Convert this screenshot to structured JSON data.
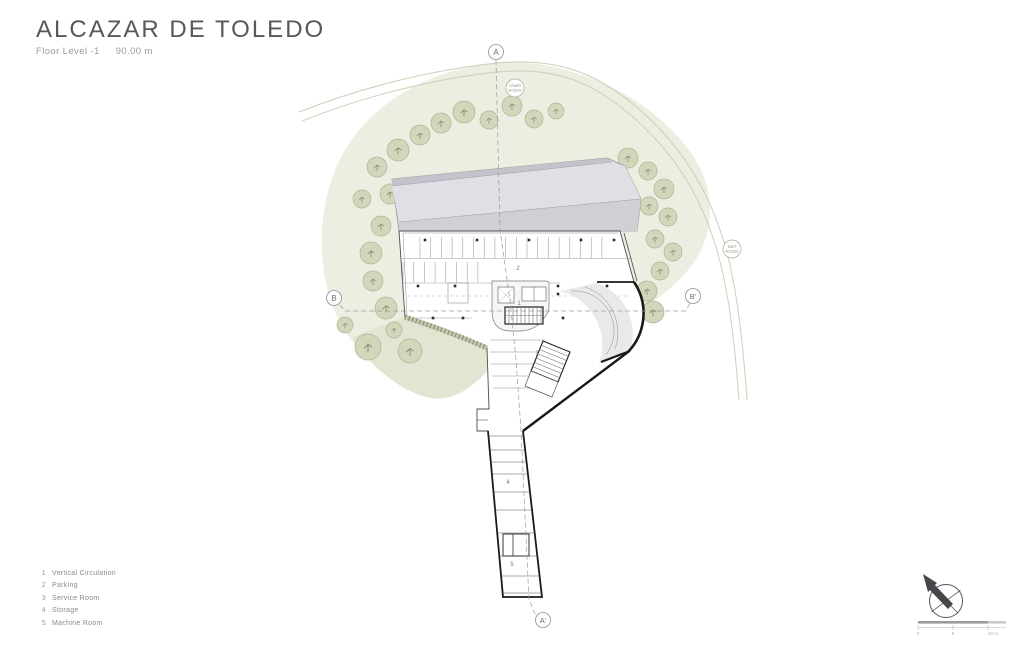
{
  "header": {
    "title": "ALCAZAR DE TOLEDO",
    "floor_label": "Floor Level -1",
    "elevation": "90.00 m"
  },
  "legend": {
    "items": [
      {
        "num": "1",
        "label": "Vertical Circulation"
      },
      {
        "num": "2",
        "label": "Parking"
      },
      {
        "num": "3",
        "label": "Service Room"
      },
      {
        "num": "4",
        "label": "Storage"
      },
      {
        "num": "5",
        "label": "Machine Room"
      }
    ]
  },
  "section_markers": {
    "top": "A",
    "bottom": "A'",
    "left": "B",
    "right": "B'"
  },
  "road_badges": {
    "north": [
      "LOWER",
      "ACCESS"
    ],
    "east": [
      "EAST",
      "ACCESS"
    ]
  },
  "plan_labels": {
    "vertical_circulation": "1",
    "parking": "2",
    "service_room": "3",
    "storage": "4",
    "machine_room": "5"
  },
  "scale_bar": {
    "ticks": [
      "0",
      "5",
      "10 m"
    ]
  },
  "colors": {
    "hill": "#ebeee0",
    "hill_shade": "#e1e5d2",
    "tree_fill": "#d2d6bb",
    "tree_stroke": "#aeb492",
    "road": "#cbd0b8",
    "roof_light": "#dfe0e5",
    "roof_mid": "#d0d1d7",
    "roof_dark": "#c3c4cb",
    "wall_thick": "#1a1a1c",
    "wall_thin": "#4c4c50"
  },
  "site": {
    "trees": [
      [
        368,
        347,
        13
      ],
      [
        410,
        351,
        12
      ],
      [
        394,
        330,
        8
      ],
      [
        345,
        325,
        8
      ],
      [
        386,
        308,
        11
      ],
      [
        373,
        281,
        10
      ],
      [
        371,
        253,
        11
      ],
      [
        381,
        226,
        10
      ],
      [
        362,
        199,
        9
      ],
      [
        390,
        194,
        10
      ],
      [
        377,
        167,
        10
      ],
      [
        398,
        150,
        11
      ],
      [
        420,
        135,
        10
      ],
      [
        441,
        123,
        10
      ],
      [
        464,
        112,
        11
      ],
      [
        489,
        120,
        9
      ],
      [
        512,
        106,
        10
      ],
      [
        534,
        119,
        9
      ],
      [
        556,
        111,
        8
      ],
      [
        628,
        158,
        10
      ],
      [
        648,
        171,
        9
      ],
      [
        664,
        189,
        10
      ],
      [
        649,
        206,
        9
      ],
      [
        668,
        217,
        9
      ],
      [
        655,
        239,
        9
      ],
      [
        673,
        252,
        9
      ],
      [
        660,
        271,
        9
      ],
      [
        647,
        291,
        10
      ],
      [
        653,
        312,
        11
      ]
    ]
  }
}
